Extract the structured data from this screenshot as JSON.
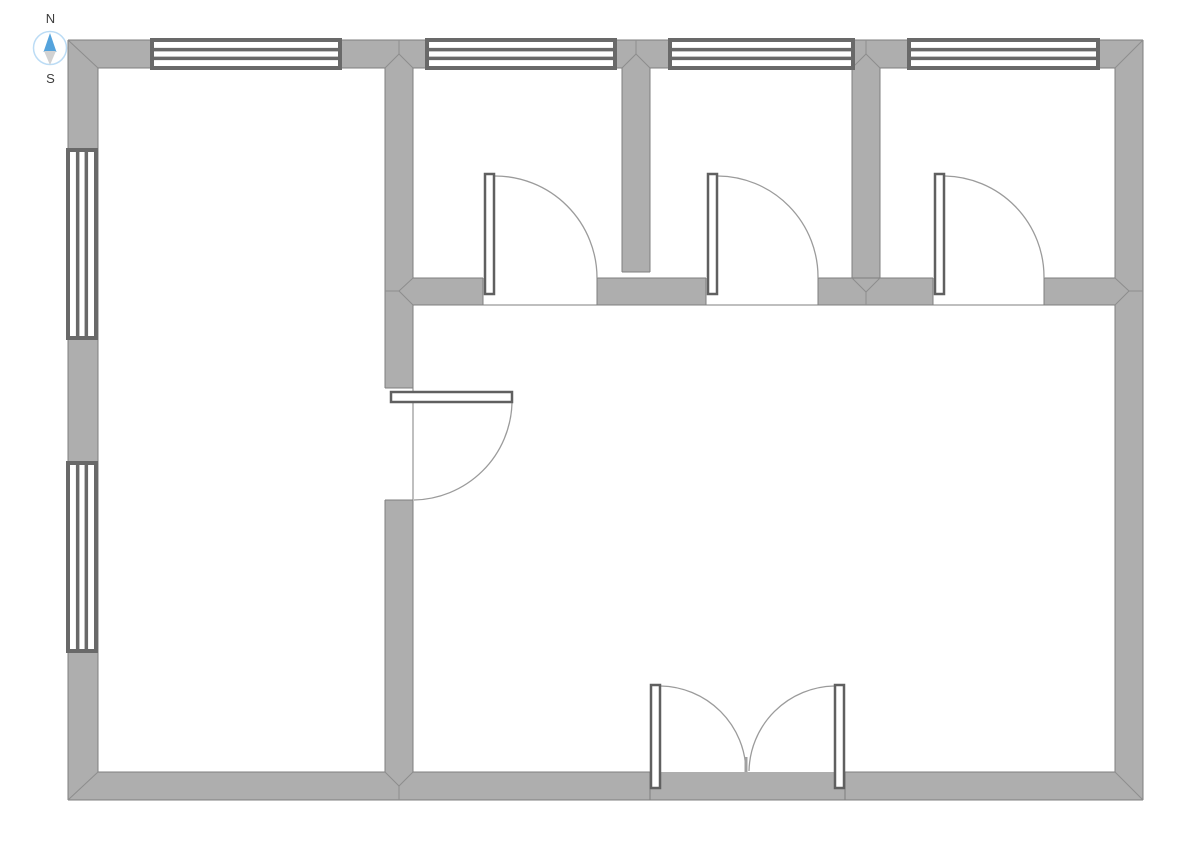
{
  "compass": {
    "north_label": "N",
    "south_label": "S",
    "cx": 50,
    "cy": 48,
    "r": 16.5,
    "circle_color": "#bcdcf5",
    "north_color": "#54a3dc",
    "south_color": "#d2d2d2",
    "text_color": "#3d3d3d",
    "font_size": 13
  },
  "plan": {
    "canvas": {
      "width": 1190,
      "height": 842,
      "background": "#ffffff"
    },
    "colors": {
      "wall_fill": "#aeaeae",
      "wall_edge": "#7f7f7f",
      "miter": "#8d8d8d",
      "window_frame": "#696969",
      "window_fill": "#ffffff",
      "door_leaf_stroke": "#606060",
      "door_leaf_fill": "#ffffff",
      "door_arc": "#9b9b9b",
      "tick": "#a0a0a0"
    },
    "walls": [
      {
        "name": "wall-exterior-north",
        "x": 68,
        "y": 40,
        "w": 1075,
        "h": 28
      },
      {
        "name": "wall-exterior-south",
        "x": 68,
        "y": 772,
        "w": 1075,
        "h": 28
      },
      {
        "name": "wall-exterior-west",
        "x": 68,
        "y": 40,
        "w": 30,
        "h": 760
      },
      {
        "name": "wall-exterior-east",
        "x": 1115,
        "y": 40,
        "w": 28,
        "h": 760
      },
      {
        "name": "wall-interior-vertical-upper",
        "x": 385,
        "y": 68,
        "w": 28,
        "h": 320
      },
      {
        "name": "wall-interior-vertical-lower",
        "x": 385,
        "y": 500,
        "w": 28,
        "h": 272
      },
      {
        "name": "wall-corridor-segment-1",
        "x": 413,
        "y": 278,
        "w": 70,
        "h": 27
      },
      {
        "name": "wall-corridor-segment-2",
        "x": 597,
        "y": 278,
        "w": 109,
        "h": 27
      },
      {
        "name": "wall-corridor-segment-3",
        "x": 818,
        "y": 278,
        "w": 115,
        "h": 27
      },
      {
        "name": "wall-corridor-segment-4",
        "x": 1044,
        "y": 278,
        "w": 71,
        "h": 27
      },
      {
        "name": "wall-divider-room1-room2",
        "x": 622,
        "y": 68,
        "w": 28,
        "h": 204
      },
      {
        "name": "wall-divider-room2-room3",
        "x": 852,
        "y": 68,
        "w": 28,
        "h": 210
      }
    ],
    "edges": [
      [
        68,
        40,
        1143,
        40
      ],
      [
        1143,
        40,
        1143,
        800
      ],
      [
        68,
        800,
        1143,
        800
      ],
      [
        68,
        40,
        68,
        800
      ],
      [
        98,
        68,
        385,
        68
      ],
      [
        413,
        68,
        622,
        68
      ],
      [
        650,
        68,
        852,
        68
      ],
      [
        880,
        68,
        1115,
        68
      ],
      [
        98,
        68,
        98,
        772
      ],
      [
        1115,
        68,
        1115,
        278
      ],
      [
        1115,
        305,
        1115,
        772
      ],
      [
        98,
        772,
        385,
        772
      ],
      [
        413,
        772,
        650,
        772
      ],
      [
        845,
        772,
        1115,
        772
      ],
      [
        385,
        68,
        385,
        388
      ],
      [
        385,
        500,
        385,
        772
      ],
      [
        413,
        68,
        413,
        278
      ],
      [
        413,
        305,
        413,
        772
      ],
      [
        385,
        388,
        413,
        388
      ],
      [
        385,
        500,
        413,
        500
      ],
      [
        413,
        278,
        483,
        278
      ],
      [
        597,
        278,
        706,
        278
      ],
      [
        818,
        278,
        933,
        278
      ],
      [
        1044,
        278,
        1115,
        278
      ],
      [
        413,
        305,
        1115,
        305
      ],
      [
        483,
        278,
        483,
        305
      ],
      [
        597,
        278,
        597,
        305
      ],
      [
        706,
        278,
        706,
        305
      ],
      [
        818,
        278,
        818,
        305
      ],
      [
        933,
        278,
        933,
        305
      ],
      [
        1044,
        278,
        1044,
        305
      ],
      [
        622,
        68,
        622,
        272
      ],
      [
        650,
        68,
        650,
        272
      ],
      [
        622,
        272,
        650,
        272
      ],
      [
        852,
        68,
        852,
        278
      ],
      [
        880,
        68,
        880,
        278
      ],
      [
        650,
        772,
        650,
        800
      ],
      [
        845,
        772,
        845,
        800
      ]
    ],
    "miters": [
      [
        68,
        40,
        98,
        68
      ],
      [
        1143,
        40,
        1115,
        68
      ],
      [
        68,
        800,
        98,
        772
      ],
      [
        1143,
        800,
        1115,
        772
      ],
      [
        385,
        68,
        399,
        54
      ],
      [
        413,
        68,
        399,
        54
      ],
      [
        399,
        54,
        399,
        40
      ],
      [
        622,
        68,
        636,
        54
      ],
      [
        650,
        68,
        636,
        54
      ],
      [
        636,
        54,
        636,
        40
      ],
      [
        852,
        68,
        866,
        54
      ],
      [
        880,
        68,
        866,
        54
      ],
      [
        866,
        54,
        866,
        40
      ],
      [
        385,
        772,
        399,
        786
      ],
      [
        413,
        772,
        399,
        786
      ],
      [
        399,
        786,
        399,
        800
      ],
      [
        1115,
        278,
        1129,
        291
      ],
      [
        1115,
        305,
        1129,
        291
      ],
      [
        1129,
        291,
        1143,
        291
      ],
      [
        413,
        278,
        399,
        291
      ],
      [
        413,
        305,
        399,
        291
      ],
      [
        399,
        291,
        385,
        291
      ],
      [
        852,
        278,
        866,
        292
      ],
      [
        880,
        278,
        866,
        292
      ],
      [
        866,
        292,
        866,
        305
      ]
    ],
    "windows": [
      {
        "name": "window-north-1",
        "x": 150,
        "y": 38,
        "w": 192,
        "h": 32,
        "dir": "h"
      },
      {
        "name": "window-north-2",
        "x": 425,
        "y": 38,
        "w": 192,
        "h": 32,
        "dir": "h"
      },
      {
        "name": "window-north-3",
        "x": 668,
        "y": 38,
        "w": 187,
        "h": 32,
        "dir": "h"
      },
      {
        "name": "window-north-4",
        "x": 907,
        "y": 38,
        "w": 193,
        "h": 32,
        "dir": "h"
      },
      {
        "name": "window-west-1",
        "x": 66,
        "y": 148,
        "w": 32,
        "h": 192,
        "dir": "v"
      },
      {
        "name": "window-west-2",
        "x": 66,
        "y": 461,
        "w": 32,
        "h": 192,
        "dir": "v"
      }
    ],
    "doors": {
      "leaves": [
        {
          "name": "door-room1-leaf",
          "x": 484,
          "y": 173,
          "w": 11,
          "h": 122
        },
        {
          "name": "door-room2-leaf",
          "x": 707,
          "y": 173,
          "w": 11,
          "h": 122
        },
        {
          "name": "door-room3-leaf",
          "x": 934,
          "y": 173,
          "w": 11,
          "h": 122
        },
        {
          "name": "door-interior-west-leaf",
          "x": 390,
          "y": 391,
          "w": 123,
          "h": 12
        },
        {
          "name": "double-door-left-leaf",
          "x": 650,
          "y": 684,
          "w": 11,
          "h": 105
        },
        {
          "name": "double-door-right-leaf",
          "x": 834,
          "y": 684,
          "w": 11,
          "h": 105
        }
      ],
      "arcs": [
        {
          "name": "door-room1-swing",
          "d": "M 495 176 A 102 102 0 0 1 597 278"
        },
        {
          "name": "door-room2-swing",
          "d": "M 718 176 A 101 101 0 0 1 818 278"
        },
        {
          "name": "door-room3-swing",
          "d": "M 945 176 A 101 101 0 0 1 1044 278"
        },
        {
          "name": "door-interior-west-swing",
          "d": "M 512 403 A 100 100 0 0 1 414 500"
        },
        {
          "name": "double-door-left-swing",
          "d": "M 661 686 A 87 87 0 0 1 746 771"
        },
        {
          "name": "double-door-right-swing",
          "d": "M 834 686 A 87 87 0 0 0 749 771"
        }
      ],
      "tick": {
        "x1": 746,
        "y1": 757,
        "x2": 746,
        "y2": 772
      }
    }
  }
}
